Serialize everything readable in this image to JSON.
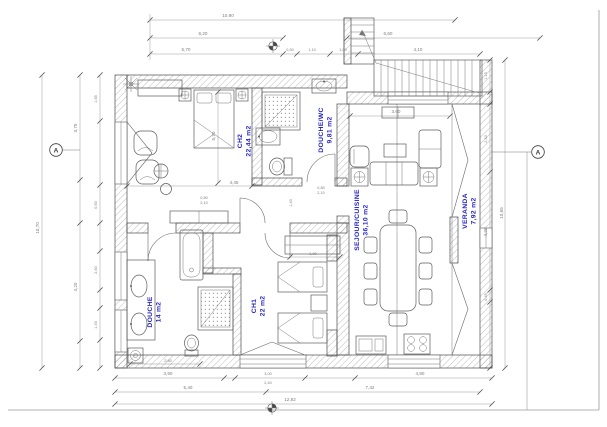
{
  "drawing_type": "architectural floor plan",
  "colors": {
    "room_label": "#2424c4",
    "wall_line": "#4a4a4a",
    "dimension": "#7d7d7d"
  },
  "rooms": {
    "ch2": {
      "name": "CH2",
      "area": "22,44 m2"
    },
    "douche_wc": {
      "name": "DOUCHE/WC",
      "area": "9,81 m2"
    },
    "douche": {
      "name": "DOUCHE",
      "area": "14 m2"
    },
    "ch1": {
      "name": "CH1",
      "area": "22 m2"
    },
    "sejour": {
      "name": "SEJOUR/CUISINE",
      "area": "36,10 m2"
    },
    "veranda": {
      "name": "VERANDA",
      "area": "7,92 m2"
    }
  },
  "section": {
    "label": "A"
  },
  "dims": {
    "top": {
      "total": "10,90",
      "seg_left": "6,20",
      "seg_right": "6,60",
      "a": "5,70",
      "b": "0,50",
      "c": "1,10",
      "d": "1,00",
      "e": "4,10"
    },
    "left": {
      "total": "10,70",
      "upper": "3,75",
      "lower": "4,20",
      "s1": "1,65",
      "s2": "0,50",
      "s3": "2,60",
      "s4": "1,45"
    },
    "right": {
      "total": "10,65",
      "s1": "1,15",
      "s2": "2,40",
      "s3": "4,20",
      "s4": "0,45"
    },
    "bottom": {
      "total": "12,82",
      "row1_a": "3,90",
      "row1_b": "3,00",
      "row1_b2": "2,40",
      "row1_c": "4,90",
      "row2_a": "5,40",
      "row2_b": "7,42"
    },
    "inner": {
      "ch2_w": "4,45",
      "ch2_h": "5,70",
      "ch1_wardrobe": "1,80",
      "douche_w": "2,80",
      "sejour_w": "3,60",
      "door_w": "0,80",
      "door_h": "2,10",
      "hall": "1,40"
    }
  }
}
